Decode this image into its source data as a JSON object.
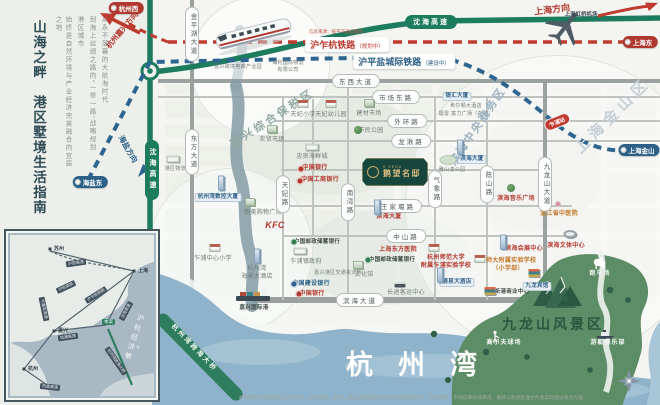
{
  "left_panel": {
    "title": "山海之畔　港区墅境生活指南",
    "desc": [
      "从永不落幕的大航海时代",
      "到海上丝绸之路的“一带一路”战略规划",
      "港区城市",
      "始终是自然环境与产业经济完美融合的宜居之地"
    ]
  },
  "railways": {
    "red_label": "沪乍杭铁路",
    "red_status": "（规划中）",
    "red_source": "信息来源：临平交通运输局",
    "blue_label": "沪平盐城际铁路",
    "blue_status": "（建设中）",
    "station": "乍浦站"
  },
  "highway": {
    "name": "沈海高速"
  },
  "airport": {
    "name": "上海虹桥机场"
  },
  "plaque": {
    "brand": "S·VEGA",
    "name": "鹅望名邸"
  },
  "areas": {
    "bay": "杭州湾",
    "scenic": "九龙山风景区",
    "bridge": "杭州湾跨海大桥"
  },
  "badges": [
    {
      "t": "杭州西",
      "bg": "#b0382f",
      "x": 126,
      "y": 8
    },
    {
      "t": "上海东",
      "bg": "#b0382f",
      "x": 640,
      "y": 42
    },
    {
      "t": "上海金山",
      "bg": "#2d6086",
      "x": 639,
      "y": 150
    },
    {
      "t": "海盐东",
      "bg": "#2d6086",
      "x": 90,
      "y": 182
    }
  ],
  "directions": [
    {
      "t": "上海方向",
      "color": "#b3372e",
      "x": 552,
      "y": 9,
      "rot": -7,
      "fs": 9
    },
    {
      "t": "杭州嘉兴方向",
      "color": "#b3372e",
      "x": 122,
      "y": 30,
      "rot": -50,
      "fs": 7.5
    },
    {
      "t": "海盐方向",
      "color": "#2d6086",
      "x": 128,
      "y": 149,
      "rot": 60,
      "fs": 7.5
    }
  ],
  "watermarks": [
    {
      "t": "嘉兴综合保税区",
      "x": 272,
      "y": 118,
      "rot": -33,
      "fs": 11,
      "color": "#92a9a2",
      "ls": 3
    },
    {
      "t": "滨海中央商务区",
      "x": 477,
      "y": 126,
      "rot": -56,
      "fs": 11,
      "color": "#9cb2c1",
      "ls": 2
    },
    {
      "t": "上海金山区",
      "x": 612,
      "y": 115,
      "rot": -45,
      "fs": 15,
      "color": "#c6d0d7",
      "ls": 5
    }
  ],
  "roads": {
    "h": [
      {
        "label": "东西大道",
        "px": 356,
        "y": 81,
        "x1": 158,
        "x2": 660,
        "w": 4.5
      },
      {
        "label": "市场东路",
        "px": 396,
        "y": 97,
        "x1": 158,
        "x2": 660,
        "w": 2.5
      },
      {
        "label": "外环路",
        "px": 407,
        "y": 121,
        "x1": 276,
        "x2": 660,
        "w": 2.5
      },
      {
        "label": "龙湫路",
        "px": 411,
        "y": 141,
        "x1": 276,
        "x2": 660,
        "w": 2.5
      },
      {
        "label": "",
        "y": 170,
        "x1": 281,
        "x2": 545,
        "w": 1.5
      },
      {
        "label": "王家堰路",
        "px": 398,
        "y": 206,
        "x1": 288,
        "x2": 572,
        "w": 2.5
      },
      {
        "label": "中山路",
        "px": 406,
        "y": 236,
        "x1": 283,
        "x2": 572,
        "w": 2.5
      },
      {
        "label": "滨海大道",
        "px": 360,
        "y": 300,
        "x1": 252,
        "x2": 578,
        "w": 5.5
      }
    ],
    "v": [
      {
        "label": "金平湖大道",
        "x": 192,
        "py": 34,
        "y1": 0,
        "y2": 300,
        "w": 4,
        "line": true
      },
      {
        "label": "东方大道",
        "x": 192,
        "py": 152,
        "line": false
      },
      {
        "label": "天妃路",
        "x": 283,
        "py": 194,
        "y1": 96,
        "y2": 300,
        "w": 2.5,
        "line": true
      },
      {
        "label": "南湾路",
        "x": 348,
        "py": 202,
        "y1": 81,
        "y2": 300,
        "w": 2.5,
        "line": true
      },
      {
        "label": "",
        "x": 313,
        "y1": 99,
        "y2": 236,
        "w": 1.5,
        "line": true
      },
      {
        "label": "气象路",
        "x": 435,
        "py": 189,
        "y1": 96,
        "y2": 300,
        "w": 2.5,
        "line": true
      },
      {
        "label": "陈山路",
        "x": 487,
        "py": 184,
        "y1": 96,
        "y2": 300,
        "w": 2.5,
        "line": true
      },
      {
        "label": "九龙山大道",
        "x": 545,
        "py": 184,
        "y1": 81,
        "y2": 316,
        "w": 4,
        "line": true
      }
    ]
  },
  "pois": [
    {
      "t": "嘉兴跨境电商产业园",
      "x": 238,
      "y": 64,
      "c": "s5"
    },
    {
      "t": "海利国际物流\n有限公司",
      "x": 288,
      "y": 60,
      "c": "s5"
    },
    {
      "t": "银汇大厦",
      "x": 457,
      "y": 92,
      "c": "chip"
    },
    {
      "t": "希尔顿大酒店",
      "x": 466,
      "y": 103,
      "c": "s5"
    },
    {
      "t": "福雷·富力广场（在建）",
      "x": 466,
      "y": 111,
      "c": "s5"
    },
    {
      "t": "天妃小学",
      "x": 303,
      "y": 112,
      "ic": "school",
      "iy": 104
    },
    {
      "t": "天妃幼儿园",
      "x": 331,
      "y": 112,
      "ic": "school",
      "iy": 104
    },
    {
      "t": "建材市场",
      "x": 369,
      "y": 111,
      "ic": "bldg",
      "iy": 103
    },
    {
      "t": "市民公园",
      "x": 371,
      "y": 128,
      "ic": "tree",
      "ix": 358,
      "iy": 130
    },
    {
      "t": "农贸市场",
      "x": 272,
      "y": 137,
      "ic": "bldg",
      "iy": 129
    },
    {
      "t": "忠贤海鲜城",
      "x": 312,
      "y": 154,
      "ic": "gov",
      "iy": 147
    },
    {
      "t": "中国银行",
      "x": 315,
      "y": 165,
      "c": "red",
      "ic": "bank-red",
      "ix": 301,
      "iy": 169
    },
    {
      "t": "中国工商银行",
      "x": 320,
      "y": 177,
      "c": "red",
      "ic": "bank-red",
      "ix": 300,
      "iy": 181
    },
    {
      "t": "物美购物广场",
      "x": 263,
      "y": 210,
      "ic": "bldg",
      "ix": 250,
      "iy": 202
    },
    {
      "t": "KFC",
      "x": 275,
      "y": 220,
      "c": "kfc"
    },
    {
      "t": "滨海大厦",
      "x": 389,
      "y": 214,
      "c": "red",
      "ic": "tower",
      "ix": 377,
      "iy": 207
    },
    {
      "t": "滨海大厦",
      "x": 472,
      "y": 155,
      "c": "chip",
      "ic": "tower",
      "ix": 460,
      "iy": 147
    },
    {
      "t": "雅山漾公园",
      "x": 452,
      "y": 167,
      "c": "s5",
      "ic": "park",
      "ix": 448,
      "iy": 160
    },
    {
      "t": "滨海音乐广场",
      "x": 516,
      "y": 196,
      "c": "red",
      "ic": "tree",
      "ix": 511,
      "iy": 188
    },
    {
      "t": "浙江省中医院",
      "x": 559,
      "y": 211,
      "c": "orange",
      "ic": "flower",
      "ix": 558,
      "iy": 204
    },
    {
      "t": "滨海文体中心",
      "x": 566,
      "y": 243,
      "c": "red",
      "ic": "stadium",
      "ix": 570,
      "iy": 234
    },
    {
      "t": "上海东方医院",
      "x": 398,
      "y": 247,
      "c": "red"
    },
    {
      "t": "中国邮政储蓄银行",
      "x": 317,
      "y": 239,
      "c": "dark",
      "ic": "bank-green",
      "ix": 294,
      "iy": 242
    },
    {
      "t": "乍浦镇政府",
      "x": 306,
      "y": 259,
      "ic": "gov",
      "ix": 300,
      "iy": 251
    },
    {
      "t": "嘉兴港区交通执法所",
      "x": 338,
      "y": 270,
      "c": "s5"
    },
    {
      "t": "中国建设银行",
      "x": 311,
      "y": 281,
      "c": "blue",
      "ic": "bank-blue",
      "ix": 294,
      "iy": 284
    },
    {
      "t": "中国银行",
      "x": 312,
      "y": 291,
      "c": "red",
      "ic": "bank-red",
      "ix": 299,
      "iy": 294
    },
    {
      "t": "中国邮政储蓄银行",
      "x": 392,
      "y": 257,
      "c": "dark",
      "ic": "bank-green",
      "ix": 368,
      "iy": 260
    },
    {
      "t": "文化馆",
      "x": 364,
      "y": 272,
      "ic": "bldg",
      "ix": 358,
      "iy": 265
    },
    {
      "t": "长途客运中心",
      "x": 406,
      "y": 290,
      "ic": "bus",
      "ix": 400,
      "iy": 285
    },
    {
      "t": "嘉兴国际港",
      "x": 254,
      "y": 305,
      "c": "dark"
    },
    {
      "t": "杭州湾\n海景大酒店",
      "x": 257,
      "y": 266,
      "ic": "tower",
      "ix": 257,
      "iy": 256
    },
    {
      "t": "杭州师范大学\n附属乍浦实验学校",
      "x": 446,
      "y": 255,
      "c": "red",
      "ic": "school",
      "ix": 434,
      "iy": 248
    },
    {
      "t": "杭师大附属实验学校\n（小学部）",
      "x": 508,
      "y": 258,
      "c": "orange",
      "ic": "school",
      "ix": 480,
      "iy": 259
    },
    {
      "t": "清泉大酒店",
      "x": 457,
      "y": 278,
      "c": "chip",
      "ic": "tower",
      "ix": 440,
      "iy": 275
    },
    {
      "t": "新港商业中心",
      "x": 512,
      "y": 289,
      "c": "dark",
      "ic": "books",
      "ix": 490,
      "iy": 291
    },
    {
      "t": "九龙宾馆",
      "x": 537,
      "y": 282,
      "c": "chip",
      "ic": "books",
      "ix": 534,
      "iy": 273
    },
    {
      "t": "滨海会展中心",
      "x": 524,
      "y": 246,
      "c": "red",
      "ic": "tower",
      "ix": 503,
      "iy": 242
    },
    {
      "t": "乍浦中心小学",
      "x": 213,
      "y": 256,
      "ic": "school",
      "ix": 215,
      "iy": 248
    },
    {
      "t": "杭州湾数控大厦",
      "x": 218,
      "y": 193,
      "c": "chip",
      "ic": "tower",
      "ix": 221,
      "iy": 183
    },
    {
      "t": "港区物流园",
      "x": 178,
      "y": 166,
      "c": "s5",
      "ic": "gov",
      "ix": 173,
      "iy": 159
    },
    {
      "t": "跑马场",
      "x": 600,
      "y": 271,
      "c": "white"
    },
    {
      "t": "高尔夫球场",
      "x": 504,
      "y": 340,
      "c": "white"
    },
    {
      "t": "游艇俱乐部",
      "x": 608,
      "y": 340,
      "c": "white"
    }
  ],
  "inset": {
    "cities": [
      {
        "t": "苏州",
        "x": 40,
        "y": 14
      },
      {
        "t": "上海",
        "x": 124,
        "y": 36
      },
      {
        "t": "嘉兴",
        "x": 44,
        "y": 96
      },
      {
        "t": "杭州",
        "x": 14,
        "y": 134
      }
    ],
    "pills": [
      {
        "t": "沪昆高速",
        "x": 66,
        "y": 28,
        "rot": -8
      },
      {
        "t": "沪杭高铁",
        "x": 56,
        "y": 52,
        "rot": -25
      },
      {
        "t": "乍嘉苏高速",
        "x": 34,
        "y": 74,
        "rot": 78
      },
      {
        "t": "沪乍杭铁路",
        "x": 86,
        "y": 60,
        "rot": -32
      },
      {
        "t": "杭浦高速",
        "x": 58,
        "y": 102,
        "rot": -8
      },
      {
        "t": "沈海高速",
        "x": 116,
        "y": 76,
        "rot": -62
      },
      {
        "t": "杭州湾跨海大桥",
        "x": 106,
        "y": 126,
        "rot": 55
      },
      {
        "t": "杭甬高速",
        "x": 40,
        "y": 152,
        "rot": 6
      }
    ],
    "marker": "本案",
    "watermark": "沪杭经济带"
  },
  "disclaimer": "本资料所示内容截至2021年9月，图中交通、教育、商业等规划信息来源于政府相关部门，仅供参考，不构成要约或承诺，最终以政府批准文件及实际建设情况为准。"
}
